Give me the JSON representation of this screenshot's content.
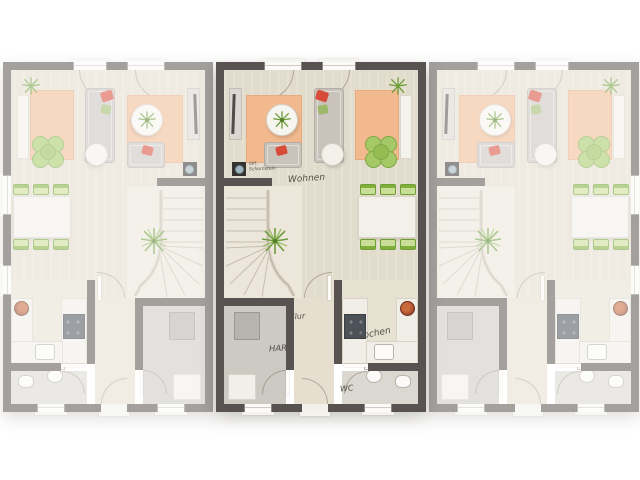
{
  "page": {
    "background": "#ffffff",
    "type": "floor-plan",
    "description": "Ground floor plan of three row-house units; centre unit highlighted, outer units faded"
  },
  "palette": {
    "wall": "#585350",
    "floor": "#e2dccc",
    "floor-stairs": "#ece7da",
    "floor-flur": "#e6dfcf",
    "floor-har": "#cdc9c3",
    "floor-wc": "#dbd8d2",
    "floor-kitchen": "#e7e1d1",
    "rug": "#f2b98f",
    "green": "#8fbe3f",
    "green-light": "#c9de96",
    "red": "#d84b38",
    "label": "#55504a",
    "counter": "#f0eee7",
    "stove": "#4d5258"
  },
  "units": [
    {
      "id": "left",
      "mirrored": true,
      "highlighted": false
    },
    {
      "id": "middle",
      "mirrored": false,
      "highlighted": true
    },
    {
      "id": "right",
      "mirrored": false,
      "highlighted": false
    }
  ],
  "labels": {
    "wohnen": "Wohnen",
    "flur": "Flur",
    "har": "HAR",
    "kochen": "Kochen",
    "wc": "WC",
    "chimney_line1": "opt.",
    "chimney_line2": "Schornstein"
  }
}
